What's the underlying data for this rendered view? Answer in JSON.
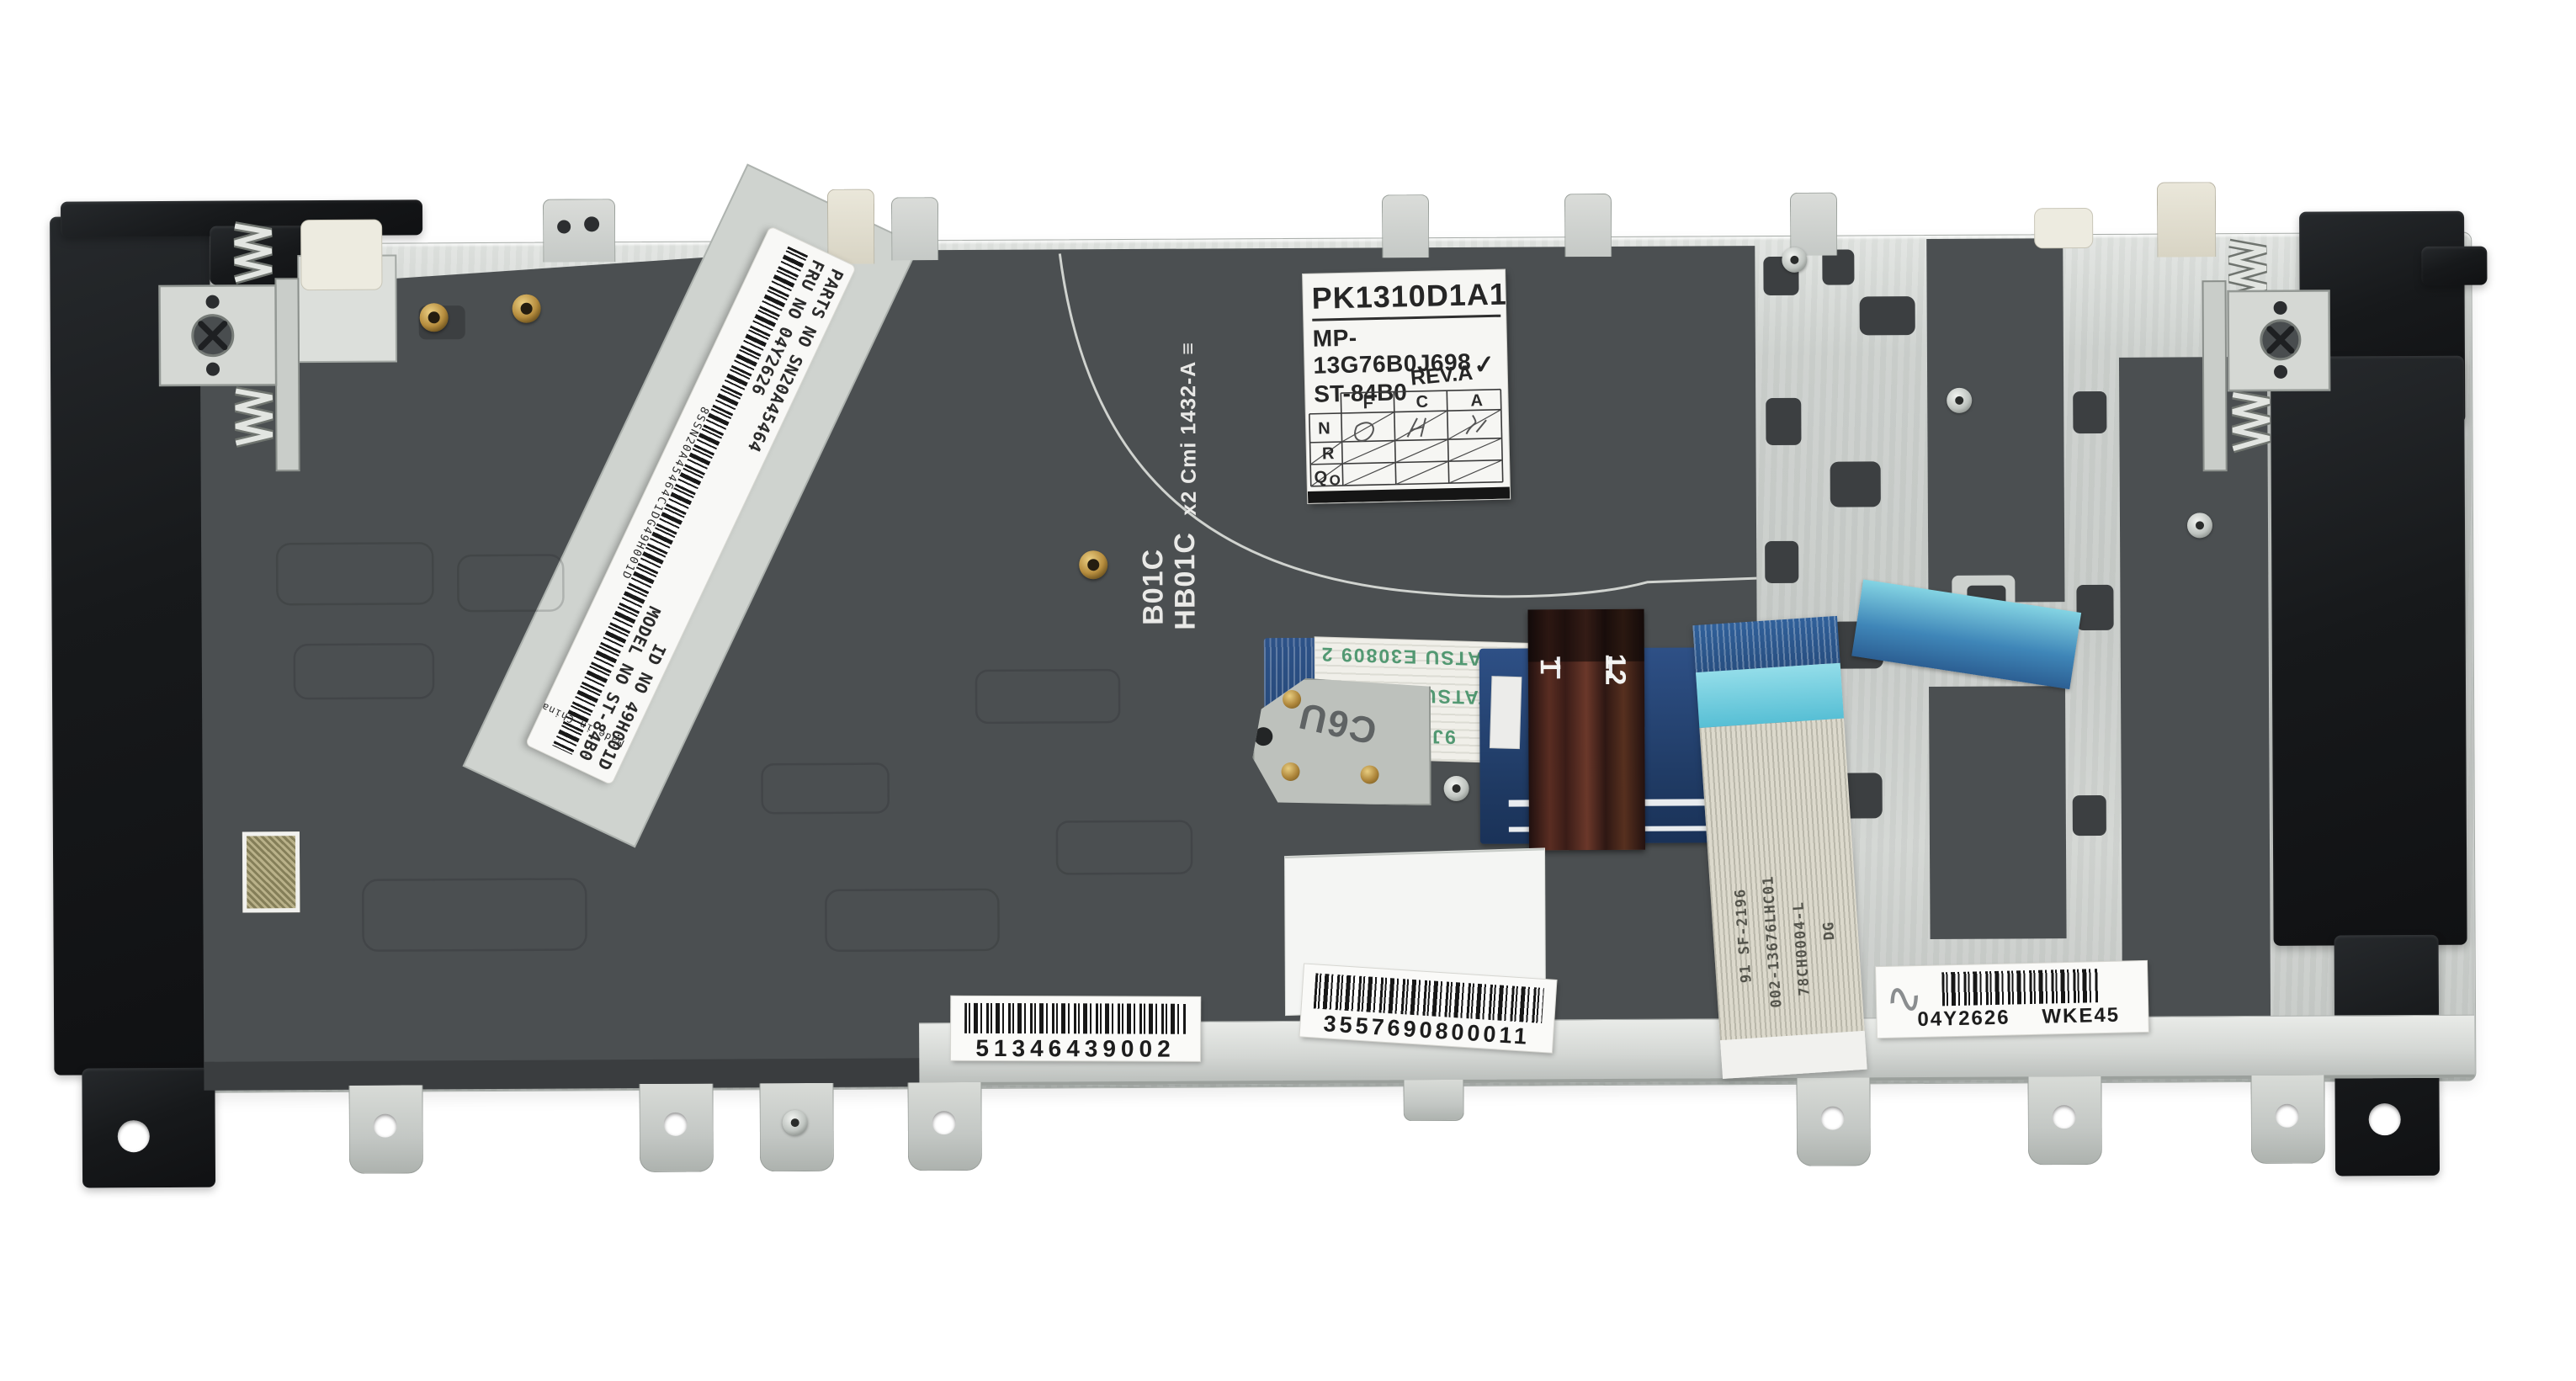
{
  "photo": {
    "subject": "Laptop keyboard assembly rear metal plate with labels and ribbon cables",
    "background": "#ffffff"
  },
  "type_label": {
    "part_number": "PK1310D1A15",
    "model_code": "MP-13G76B0J698",
    "series_code": "ST-84B0",
    "revision": "REV.A",
    "check_mark": "✓",
    "grid_columns": [
      "F",
      "C",
      "A"
    ],
    "grid_rows": [
      "N",
      "R",
      "Q",
      "O"
    ]
  },
  "fru_sticker": {
    "parts_no": "PARTS NO SN20A45464",
    "fru_no": "FRU NO 04Y2626",
    "id_no": "ID NO 49H001D",
    "model_no": "MODEL NO ST-84B0",
    "barcode_text": "8SSN20A45464C1DG49H001D",
    "origin": "Made in China"
  },
  "film_markings": {
    "qty_mark": "x2 Cmi 1432-A ≡",
    "code_top": "B01C",
    "code_bottom": "HB01C"
  },
  "ribbon_stamps": {
    "rows": [
      "TATSU E30809 2",
      "9J TATSU E30809 2",
      "9J E30809 2"
    ],
    "bracket_stamp": "C6U"
  },
  "connector_pins": {
    "first": "1",
    "last": "12"
  },
  "blue_cable_markings": {
    "col1": "91 SF-2196",
    "col2": "002-13676LHC01",
    "col3": "78CH0004-L",
    "col4": "DG"
  },
  "barcode_labels": {
    "left": {
      "value": "51346439002"
    },
    "center": {
      "value": "3557690800011"
    },
    "right": {
      "mark": "∿",
      "code": "04Y2626",
      "station": "WKE45"
    }
  }
}
